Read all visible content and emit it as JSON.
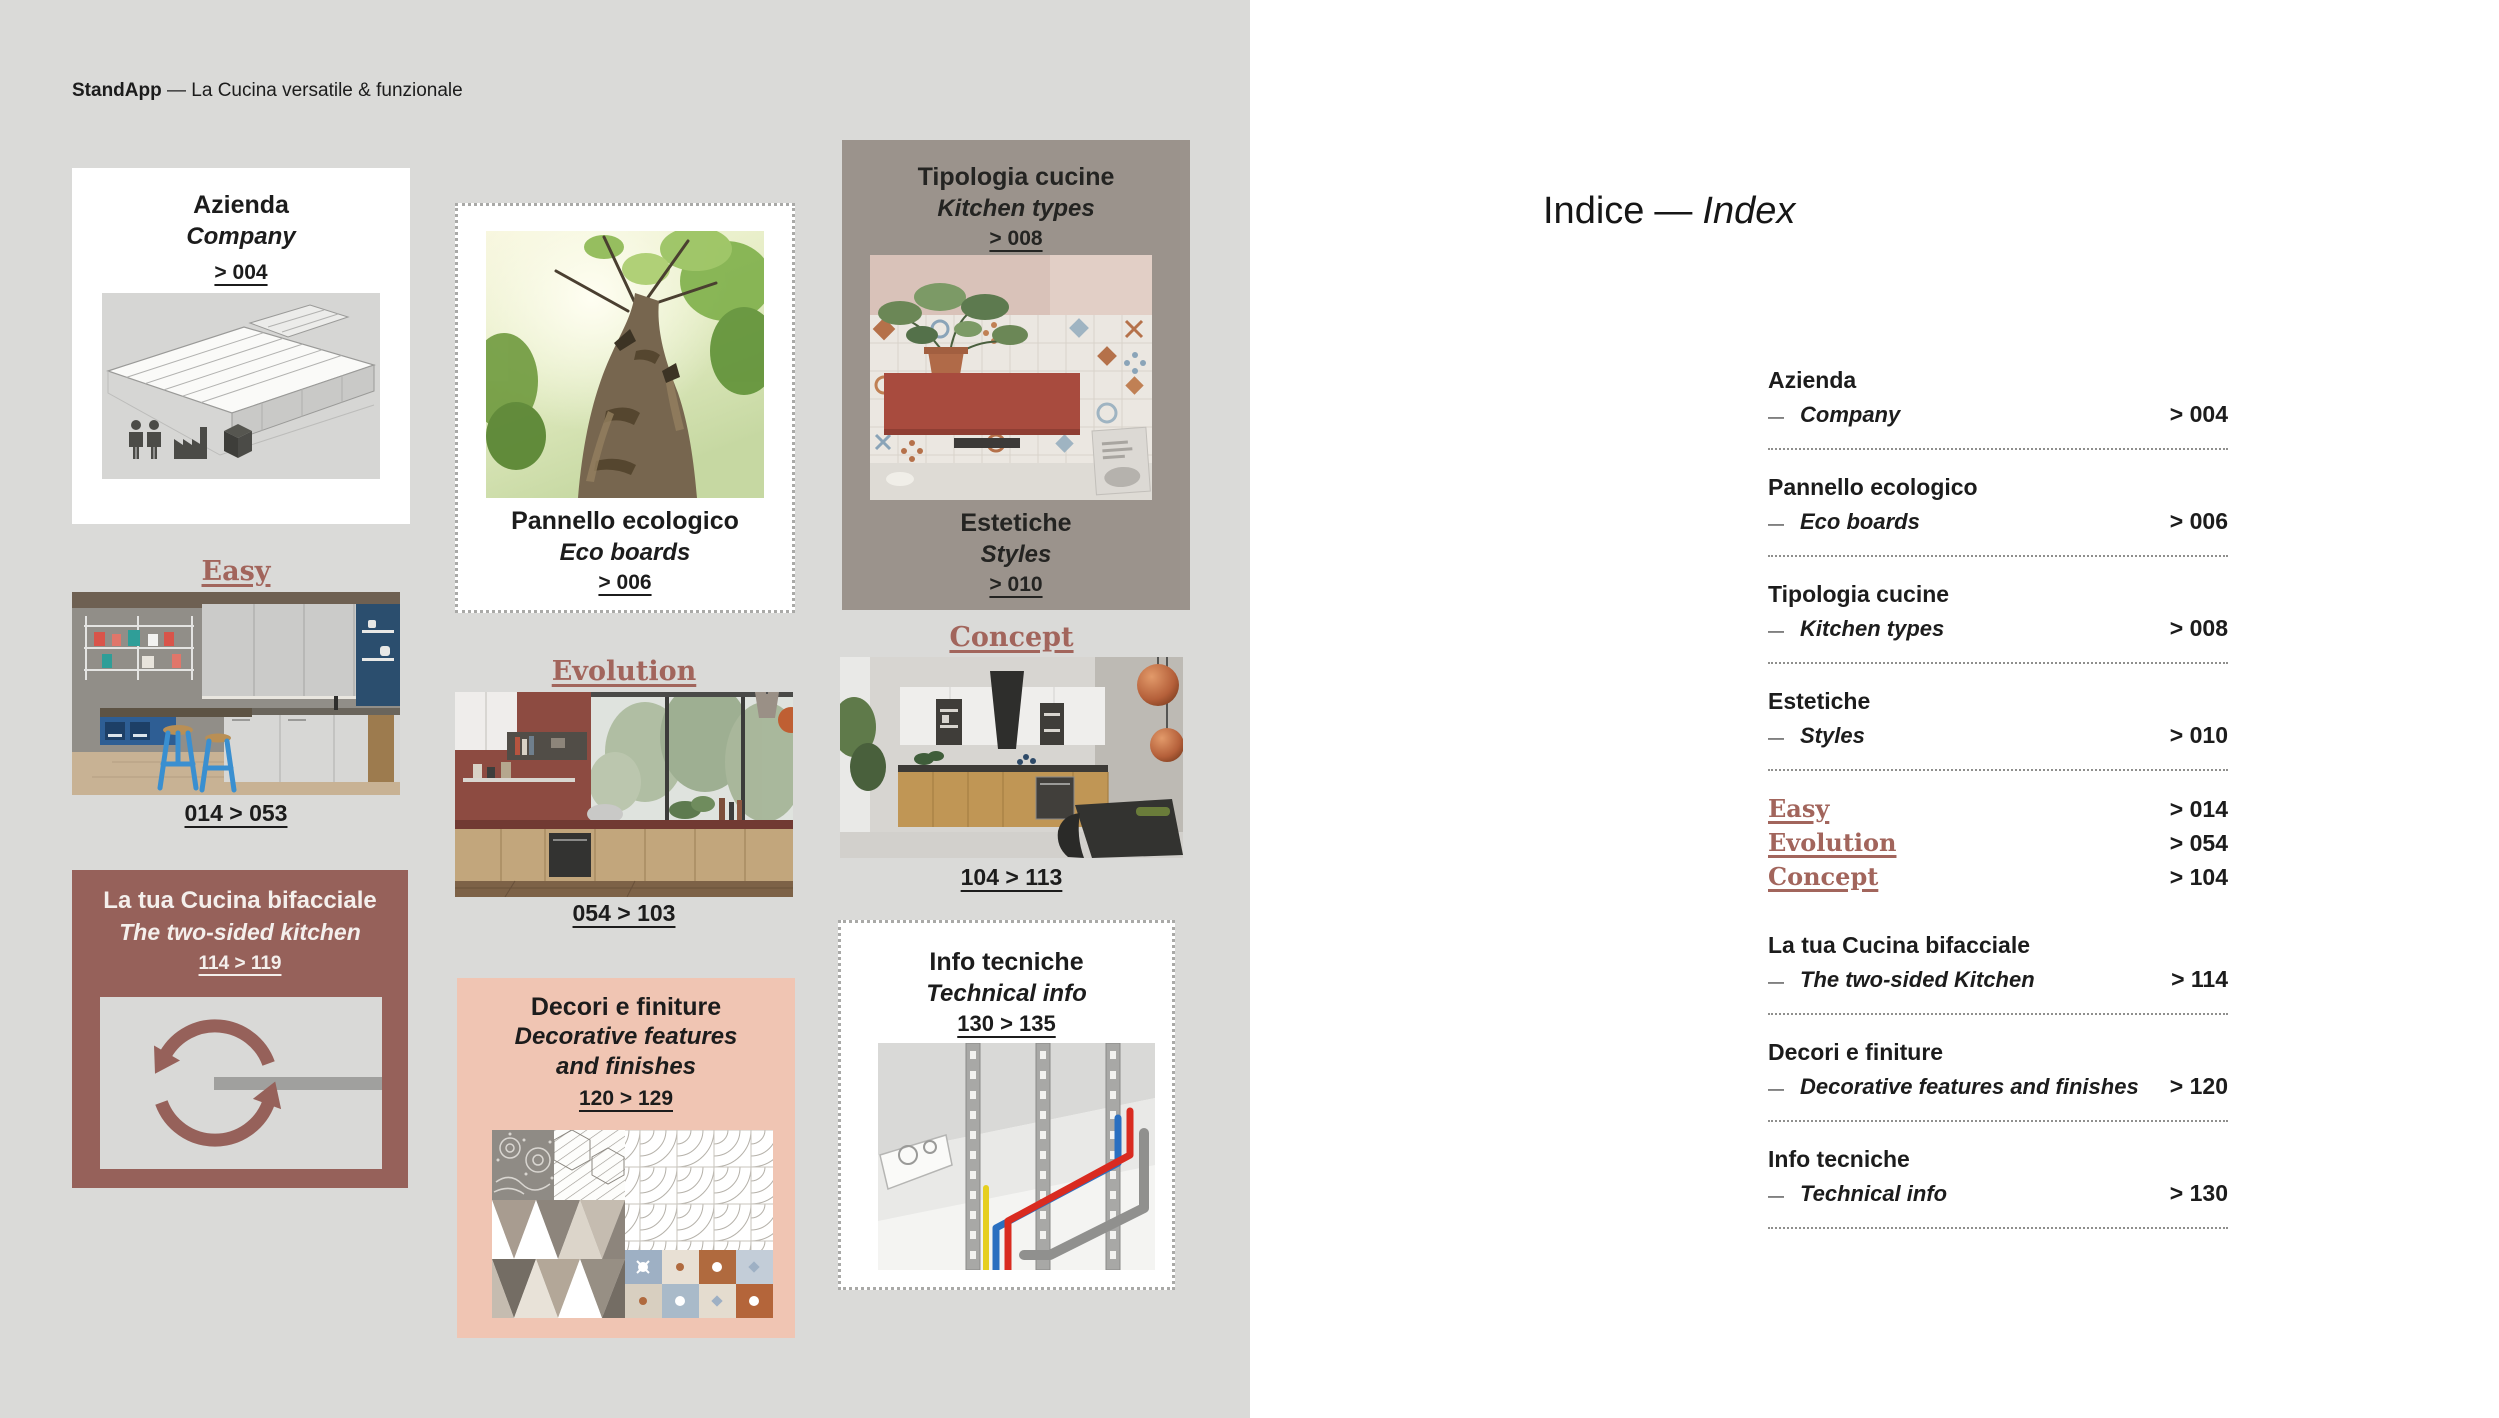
{
  "header": {
    "brand": "StandApp",
    "tagline": "— La Cucina versatile & funzionale"
  },
  "colors": {
    "page_bg_left": "#dadad8",
    "page_bg_right": "#ffffff",
    "maroon_card": "#96615a",
    "pink_card": "#f0c5b3",
    "taupe_card": "#9b938c",
    "serif_accent": "#a2655c",
    "text": "#1c1c1c"
  },
  "cards": {
    "azienda": {
      "title": "Azienda",
      "subtitle": "Company",
      "ref": "> 004"
    },
    "easy": {
      "title": "Easy",
      "range": "014 > 053"
    },
    "bifacciale": {
      "title": "La tua Cucina bifacciale",
      "subtitle": "The two-sided kitchen",
      "range": "114 > 119"
    },
    "pannello": {
      "title": "Pannello ecologico",
      "subtitle": "Eco boards",
      "ref": "> 006"
    },
    "evolution": {
      "title": "Evolution",
      "range": "054 > 103"
    },
    "decori": {
      "title": "Decori e finiture",
      "subtitle_line1": "Decorative features",
      "subtitle_line2": "and finishes",
      "range": "120 > 129"
    },
    "tipologia": {
      "title": "Tipologia cucine",
      "subtitle": "Kitchen types",
      "ref": "> 008"
    },
    "estetiche": {
      "title": "Estetiche",
      "subtitle": "Styles",
      "ref": "> 010"
    },
    "concept": {
      "title": "Concept",
      "range": "104 > 113"
    },
    "info": {
      "title": "Info tecniche",
      "subtitle": "Technical info",
      "range": "130 > 135"
    }
  },
  "icons": {
    "factory_illustration": "factory-illustration",
    "people": "people-icon",
    "factory": "factory-icon",
    "package": "package-icon",
    "rotation": "rotation-arrows-icon",
    "easy_photo": "easy-kitchen-photo",
    "tree_photo": "eco-tree-photo",
    "evolution_photo": "evolution-kitchen-photo",
    "tiles_photo": "kitchen-types-photo",
    "concept_photo": "concept-kitchen-photo",
    "patterns_collage": "decorative-patterns-collage",
    "technical_diagram": "technical-pipes-diagram"
  },
  "index": {
    "title_it": "Indice",
    "dash": "—",
    "title_en": "Index",
    "entries": [
      {
        "it": "Azienda",
        "en": "Company",
        "page": "> 004"
      },
      {
        "it": "Pannello ecologico",
        "en": "Eco boards",
        "page": "> 006"
      },
      {
        "it": "Tipologia cucine",
        "en": "Kitchen types",
        "page": "> 008"
      },
      {
        "it": "Estetiche",
        "en": "Styles",
        "page": "> 010"
      },
      {
        "label": "Easy",
        "page": "> 014"
      },
      {
        "label": "Evolution",
        "page": "> 054"
      },
      {
        "label": "Concept",
        "page": "> 104"
      },
      {
        "it": "La tua Cucina bifacciale",
        "en": "The two-sided Kitchen",
        "page": "> 114"
      },
      {
        "it": "Decori e finiture",
        "en": "Decorative features and finishes",
        "page": "> 120"
      },
      {
        "it": "Info tecniche",
        "en": "Technical info",
        "page": "> 130"
      }
    ]
  }
}
